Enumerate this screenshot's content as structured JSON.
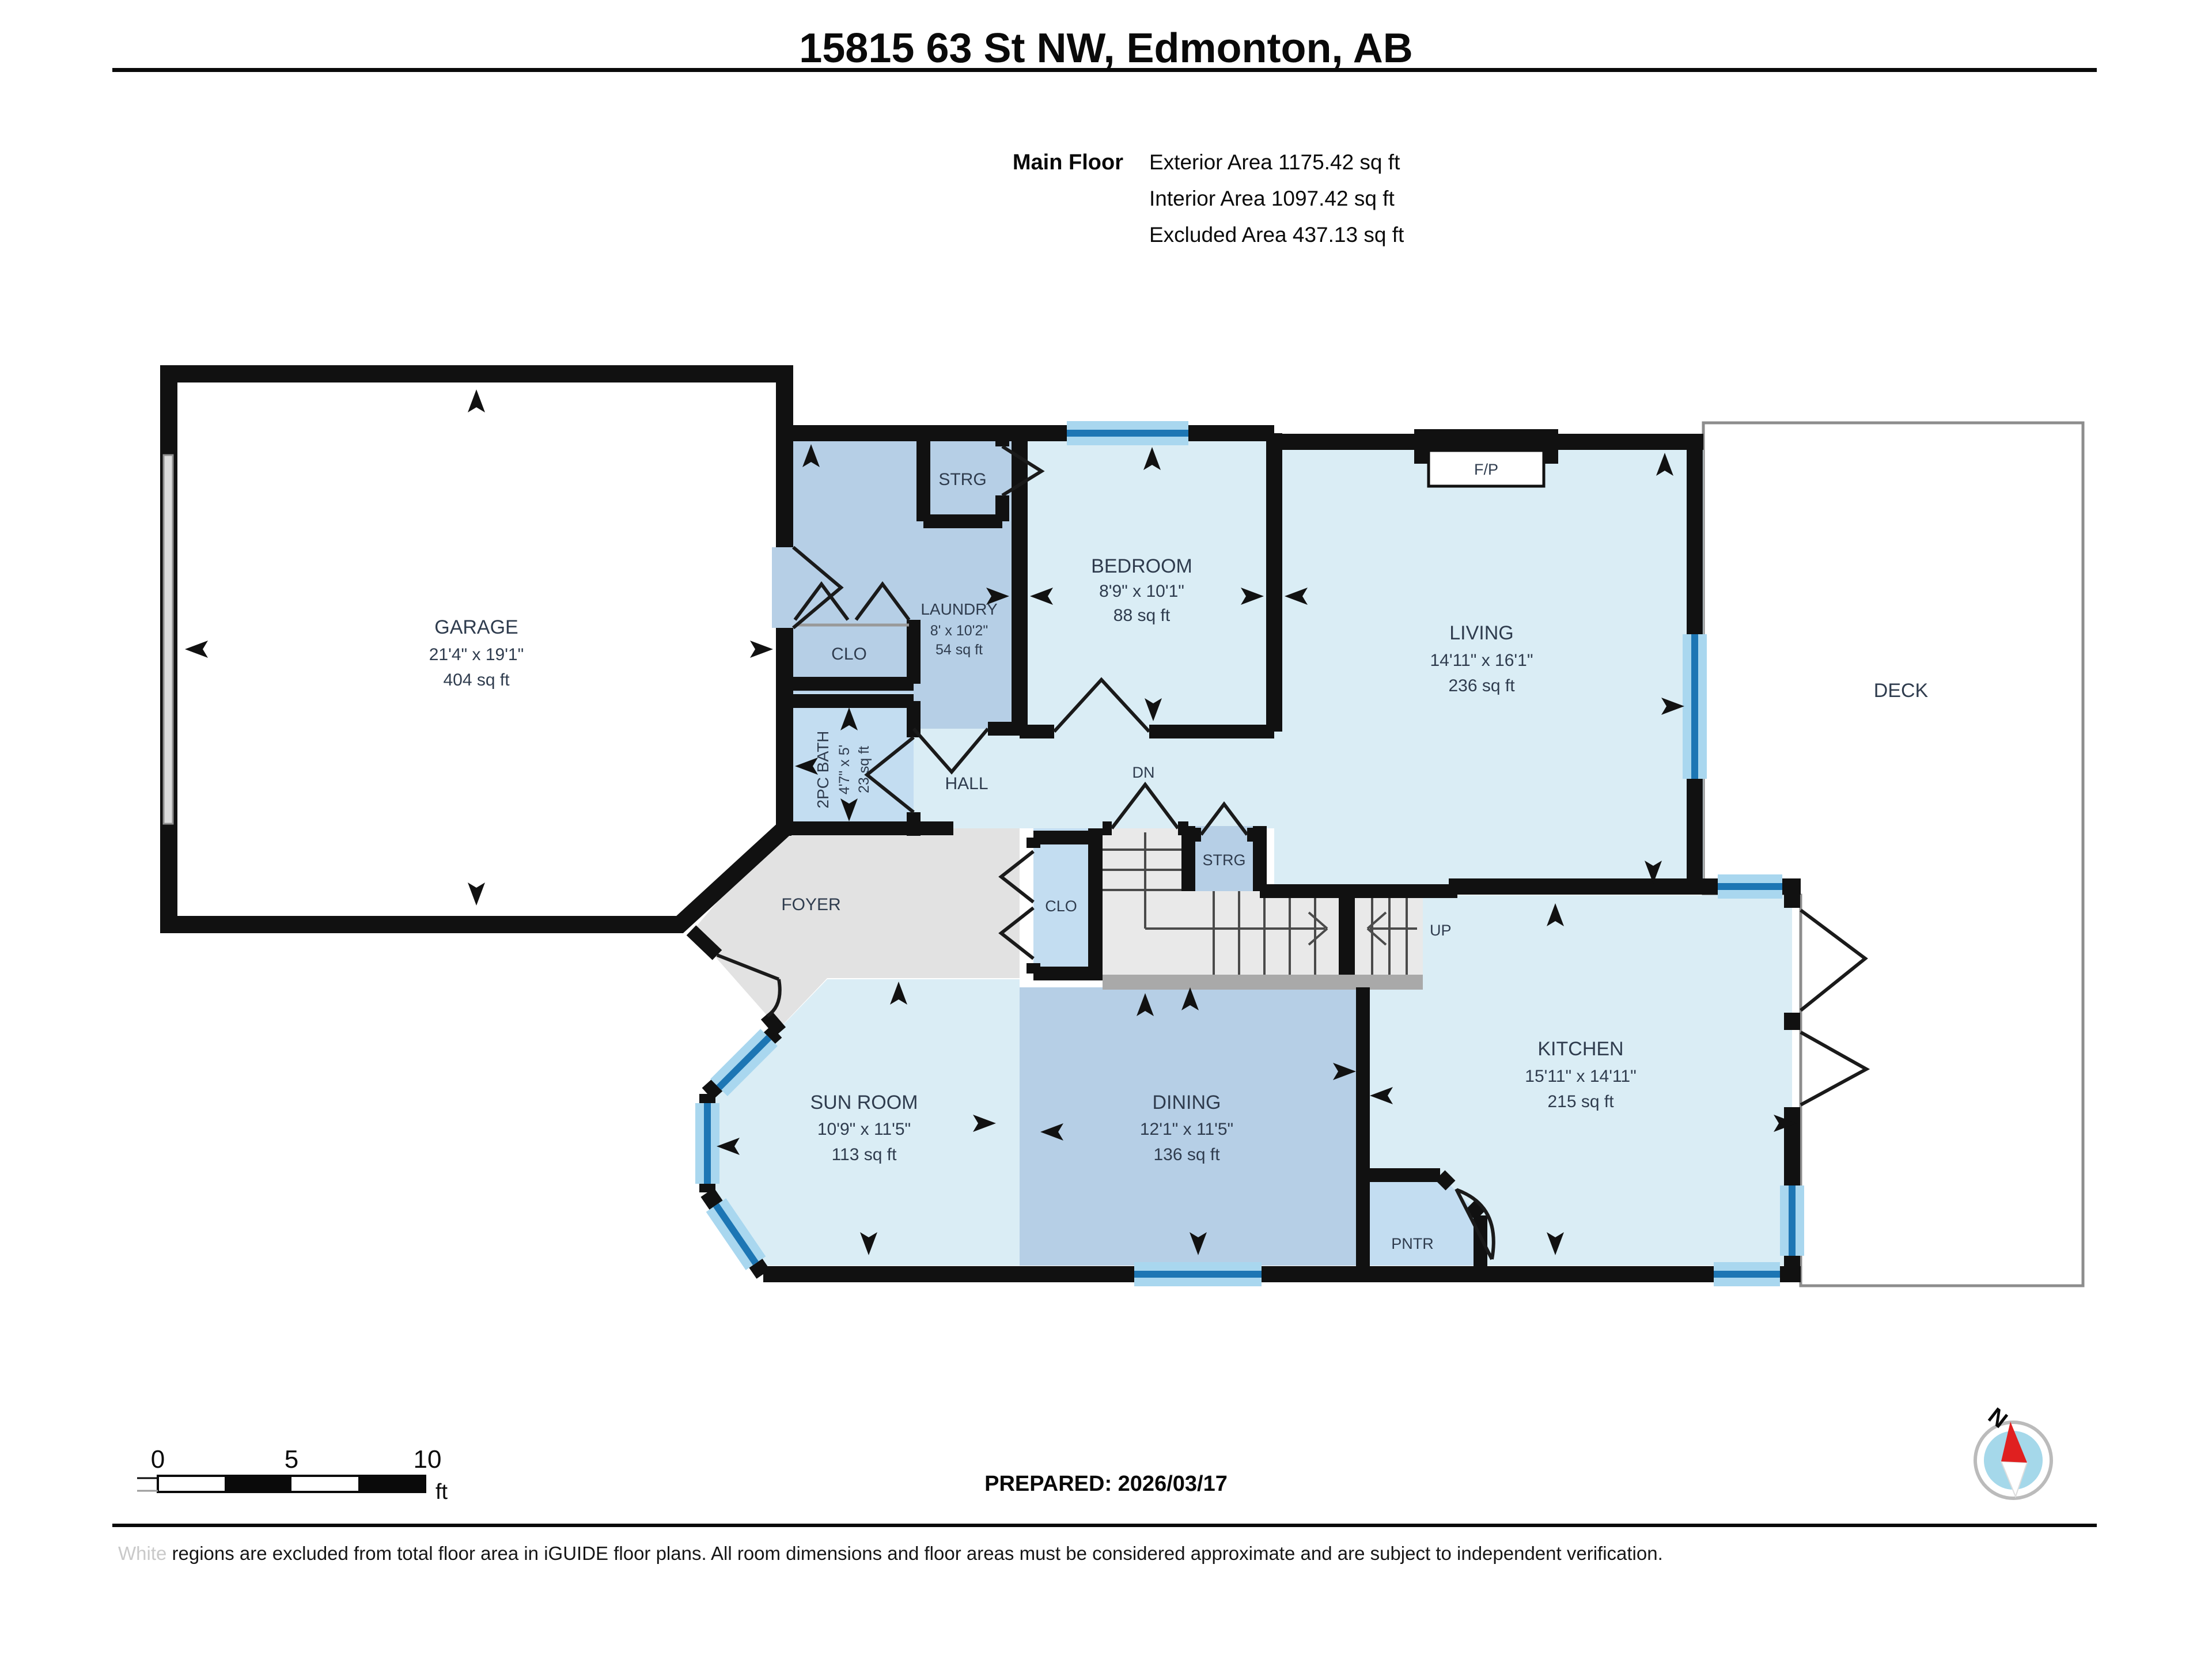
{
  "document": {
    "title": "15815 63 St NW, Edmonton, AB",
    "floor_label": "Main Floor",
    "stats": [
      "Exterior Area 1175.42 sq ft",
      "Interior Area 1097.42 sq ft",
      "Excluded Area 437.13 sq ft"
    ]
  },
  "rooms": {
    "garage": {
      "name": "GARAGE",
      "dims": "21'4\" x 19'1\"",
      "area": "404 sq ft"
    },
    "laundry": {
      "name": "LAUNDRY",
      "dims": "8' x 10'2\"",
      "area": "54 sq ft"
    },
    "bedroom": {
      "name": "BEDROOM",
      "dims": "8'9\" x 10'1\"",
      "area": "88 sq ft"
    },
    "living": {
      "name": "LIVING",
      "dims": "14'11\" x 16'1\"",
      "area": "236 sq ft"
    },
    "kitchen": {
      "name": "KITCHEN",
      "dims": "15'11\" x 14'11\"",
      "area": "215 sq ft"
    },
    "dining": {
      "name": "DINING",
      "dims": "12'1\" x 11'5\"",
      "area": "136 sq ft"
    },
    "sunroom": {
      "name": "SUN ROOM",
      "dims": "10'9\" x 11'5\"",
      "area": "113 sq ft"
    },
    "bath": {
      "name": "2PC BATH",
      "dims": "4'7\" x 5'",
      "area": "23 sq ft"
    }
  },
  "labels": {
    "deck": "DECK",
    "foyer": "FOYER",
    "hall": "HALL",
    "fireplace": "F/P",
    "storage_top": "STRG",
    "storage_stairs": "STRG",
    "closet_garage": "CLO",
    "closet_stairs": "CLO",
    "pantry": "PNTR",
    "stairs_down": "DN",
    "stairs_up": "UP"
  },
  "footer": {
    "scale_ticks": [
      "0",
      "5",
      "10"
    ],
    "scale_unit": "ft",
    "prepared": "PREPARED: 2026/03/17",
    "compass_north": "N",
    "disclaimer_highlight": "White",
    "disclaimer_rest": " regions are excluded from total floor area in iGUIDE floor plans. All room dimensions and floor areas must be considered approximate and are subject to independent verification."
  },
  "colors": {
    "room_light": "#daedf5",
    "room_medium": "#b6cfe6",
    "room_pale": "#c3ddf1",
    "excluded_gray": "#e2e2e2",
    "wall": "#111111",
    "window_core": "#1d76b4",
    "window_glow": "#a9d7ef",
    "compass_needle": "#e02020"
  }
}
